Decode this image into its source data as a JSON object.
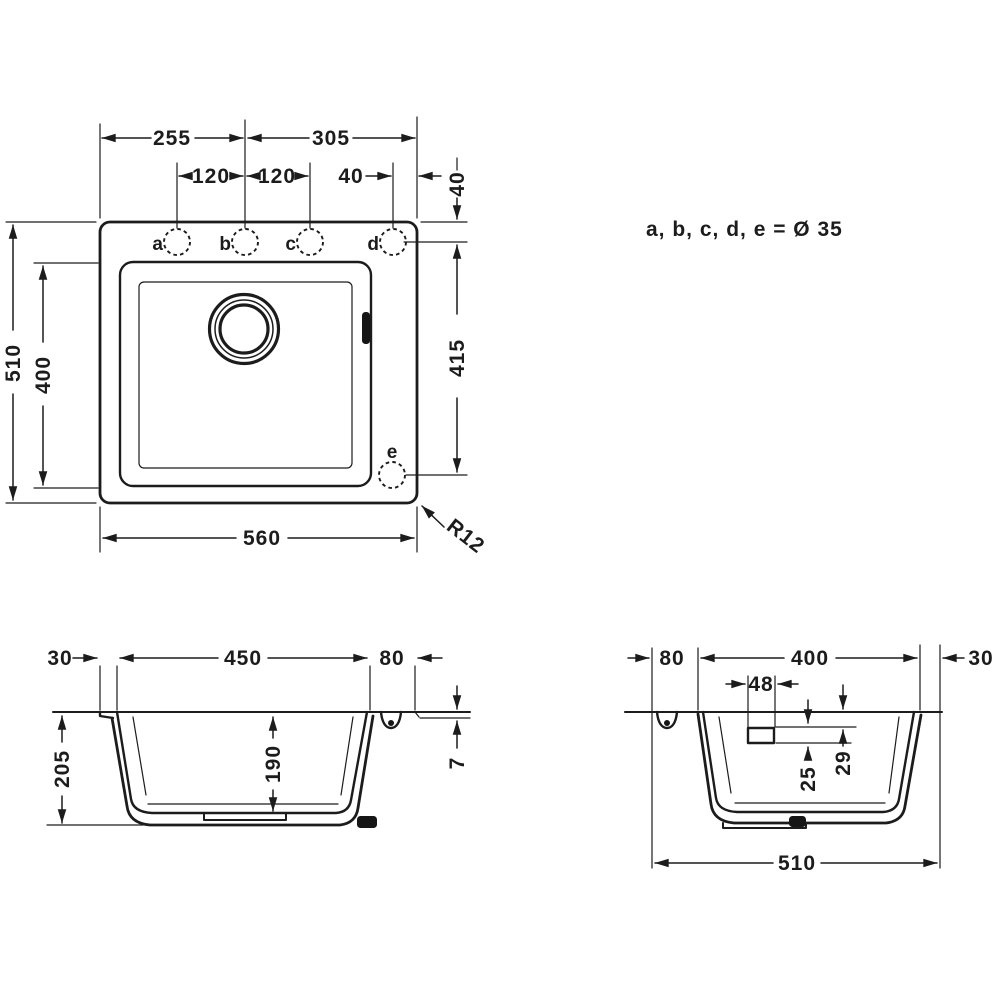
{
  "drawing": {
    "note": "a, b, c, d, e = Ø 35",
    "top_view": {
      "dim_255": "255",
      "dim_305": "305",
      "dim_120_ab": "120",
      "dim_120_bc": "120",
      "dim_40_d": "40",
      "dim_40_top": "40",
      "dim_415": "415",
      "dim_510": "510",
      "dim_400": "400",
      "dim_560": "560",
      "corner_radius": "R12",
      "holes": {
        "a": "a",
        "b": "b",
        "c": "c",
        "d": "d",
        "e": "e"
      }
    },
    "front_section": {
      "dim_30": "30",
      "dim_450": "450",
      "dim_80": "80",
      "dim_205": "205",
      "dim_190": "190",
      "dim_7": "7"
    },
    "side_section": {
      "dim_80": "80",
      "dim_400": "400",
      "dim_30": "30",
      "dim_48": "48",
      "dim_25": "25",
      "dim_29": "29",
      "dim_510": "510"
    }
  }
}
